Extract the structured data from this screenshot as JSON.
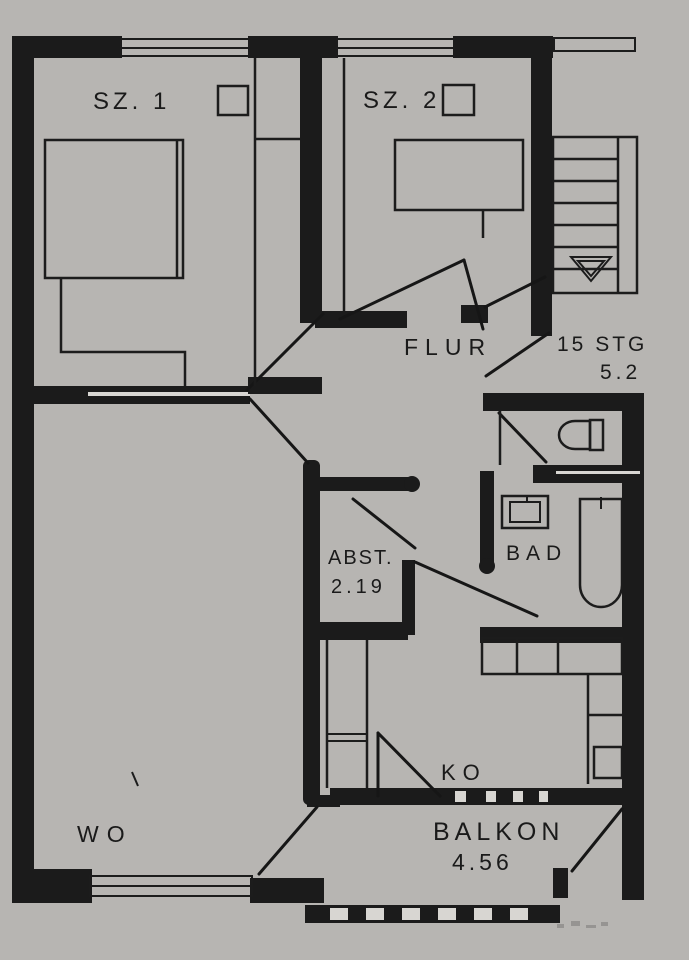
{
  "meta": {
    "title": "Apartment floor plan (Grundriss), black ink on grey paper",
    "plan_type": "floor-plan"
  },
  "colors": {
    "paper": "#d6d4d0",
    "paper_light": "#ebeae7",
    "ink": "#1b1b1b"
  },
  "rooms": {
    "sz1": {
      "label": "SZ. 1"
    },
    "sz2": {
      "label": "SZ. 2"
    },
    "flur": {
      "label": "FLUR"
    },
    "abst": {
      "label": "ABST.",
      "area": "2.19"
    },
    "bad": {
      "label": "BAD"
    },
    "ko": {
      "label": "KO"
    },
    "wo": {
      "label": "WO"
    },
    "balkon": {
      "label": "BALKON",
      "area": "4.56"
    }
  },
  "stairs": {
    "steps_label": "15 STG",
    "measure": "5.2"
  },
  "symbols": {
    "beds": 2,
    "bathtub": 1,
    "sink": 2,
    "toilet": 1,
    "stair_arrow": "down-triangle",
    "windows": 3,
    "door_swings": 10,
    "square_markers": 2
  }
}
